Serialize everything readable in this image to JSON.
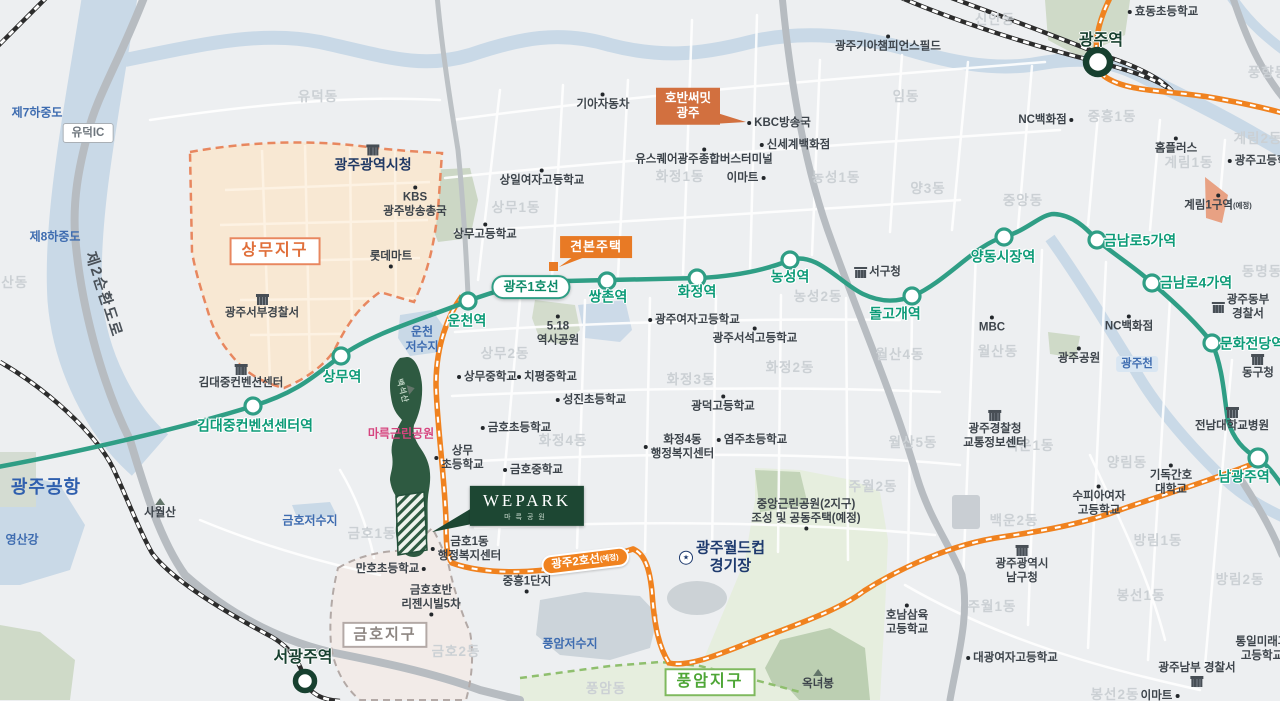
{
  "map": {
    "subway_line1_label": "광주1호선",
    "subway_line2_label": "광주2호선",
    "subway_line2_suffix": "(예정)",
    "colors": {
      "background": "#edeff1",
      "water": "#c9d9e7",
      "line1": "#2f9e85",
      "line2": "#f0821f",
      "park_dark": "#2e5a41",
      "sangmu_fill": "#f8e8d3",
      "sangmu_border": "#e8875f",
      "geumho_fill": "#f2ebe8",
      "pungam_fill": "#e6eede",
      "wepark_box": "#1d4733",
      "callout_orange": "#d2703f",
      "station_text": "#0d9b78",
      "rail_dark": "#17402f"
    },
    "labels": [
      {
        "t": "유덕동",
        "x": 318,
        "y": 97,
        "c": "dong"
      },
      {
        "t": "우산동",
        "x": 8,
        "y": 283,
        "c": "dong"
      },
      {
        "t": "신안동",
        "x": 995,
        "y": 20,
        "c": "dong"
      },
      {
        "t": "임동",
        "x": 906,
        "y": 97,
        "c": "dong"
      },
      {
        "t": "중흥1동",
        "x": 1112,
        "y": 117,
        "c": "dong"
      },
      {
        "t": "풍향동",
        "x": 1268,
        "y": 73,
        "c": "dong"
      },
      {
        "t": "계림2동",
        "x": 1258,
        "y": 139,
        "c": "dong"
      },
      {
        "t": "계림1동",
        "x": 1189,
        "y": 163,
        "c": "dong"
      },
      {
        "t": "양3동",
        "x": 928,
        "y": 189,
        "c": "dong"
      },
      {
        "t": "중앙동",
        "x": 1023,
        "y": 201,
        "c": "dong"
      },
      {
        "t": "동명동",
        "x": 1262,
        "y": 272,
        "c": "dong"
      },
      {
        "t": "상무1동",
        "x": 516,
        "y": 208,
        "c": "dong"
      },
      {
        "t": "화정1동",
        "x": 680,
        "y": 177,
        "c": "dong"
      },
      {
        "t": "농성1동",
        "x": 836,
        "y": 178,
        "c": "dong"
      },
      {
        "t": "상무2동",
        "x": 505,
        "y": 354,
        "c": "dong"
      },
      {
        "t": "농성2동",
        "x": 818,
        "y": 297,
        "c": "dong"
      },
      {
        "t": "화정2동",
        "x": 790,
        "y": 368,
        "c": "dong"
      },
      {
        "t": "화정3동",
        "x": 691,
        "y": 380,
        "c": "dong"
      },
      {
        "t": "화정4동",
        "x": 563,
        "y": 441,
        "c": "dong"
      },
      {
        "t": "월산4동",
        "x": 900,
        "y": 355,
        "c": "dong"
      },
      {
        "t": "월산동",
        "x": 998,
        "y": 352,
        "c": "dong"
      },
      {
        "t": "월산5동",
        "x": 913,
        "y": 443,
        "c": "dong"
      },
      {
        "t": "백운1동",
        "x": 1030,
        "y": 446,
        "c": "dong"
      },
      {
        "t": "백운2동",
        "x": 1014,
        "y": 521,
        "c": "dong"
      },
      {
        "t": "양림동",
        "x": 1127,
        "y": 463,
        "c": "dong"
      },
      {
        "t": "주월2동",
        "x": 873,
        "y": 487,
        "c": "dong"
      },
      {
        "t": "주월1동",
        "x": 992,
        "y": 607,
        "c": "dong"
      },
      {
        "t": "방림1동",
        "x": 1158,
        "y": 541,
        "c": "dong"
      },
      {
        "t": "방림2동",
        "x": 1240,
        "y": 580,
        "c": "dong"
      },
      {
        "t": "봉선1동",
        "x": 1141,
        "y": 596,
        "c": "dong"
      },
      {
        "t": "봉선2동",
        "x": 1115,
        "y": 695,
        "c": "dong"
      },
      {
        "t": "금호1동",
        "x": 372,
        "y": 534,
        "c": "dong"
      },
      {
        "t": "금호2동",
        "x": 456,
        "y": 652,
        "c": "dong"
      },
      {
        "t": "풍암동",
        "x": 606,
        "y": 689,
        "c": "dong"
      },
      {
        "t": "제7하중도",
        "x": 37,
        "y": 113,
        "c": "water"
      },
      {
        "t": "제8하중도",
        "x": 55,
        "y": 237,
        "c": "water"
      },
      {
        "t": "영산강",
        "x": 22,
        "y": 540,
        "c": "water"
      },
      {
        "t": "광주공항",
        "x": 46,
        "y": 488,
        "c": "water-big"
      },
      {
        "t": "운천\n저수지",
        "x": 422,
        "y": 339,
        "c": "water"
      },
      {
        "t": "금호저수지",
        "x": 310,
        "y": 521,
        "c": "water"
      },
      {
        "t": "풍암저수지",
        "x": 570,
        "y": 644,
        "c": "water"
      },
      {
        "t": "광주천",
        "x": 1137,
        "y": 364,
        "c": "wtag"
      },
      {
        "t": "운천역",
        "x": 467,
        "y": 321,
        "c": "st"
      },
      {
        "t": "상무역",
        "x": 342,
        "y": 377,
        "c": "st"
      },
      {
        "t": "김대중컨벤션센터역",
        "x": 255,
        "y": 426,
        "c": "st"
      },
      {
        "t": "쌍촌역",
        "x": 608,
        "y": 297,
        "c": "st"
      },
      {
        "t": "화정역",
        "x": 697,
        "y": 292,
        "c": "st"
      },
      {
        "t": "농성역",
        "x": 790,
        "y": 277,
        "c": "st"
      },
      {
        "t": "돌고개역",
        "x": 895,
        "y": 314,
        "c": "st"
      },
      {
        "t": "양동시장역",
        "x": 1003,
        "y": 257,
        "c": "st"
      },
      {
        "t": "금남로5가역",
        "x": 1140,
        "y": 241,
        "c": "st"
      },
      {
        "t": "금남로4가역",
        "x": 1196,
        "y": 283,
        "c": "st"
      },
      {
        "t": "문화전당역",
        "x": 1252,
        "y": 344,
        "c": "st"
      },
      {
        "t": "남광주역",
        "x": 1244,
        "y": 477,
        "c": "st"
      },
      {
        "t": "광주역",
        "x": 1101,
        "y": 41,
        "c": "strail"
      },
      {
        "t": "서광주역",
        "x": 303,
        "y": 658,
        "c": "strail"
      },
      {
        "t": "광주광역시청",
        "x": 373,
        "y": 159,
        "c": "city",
        "i": "b",
        "ip": "t"
      },
      {
        "t": "광주월드컵\n경기장",
        "x": 722,
        "y": 558,
        "c": "stadium",
        "i": "s",
        "ip": "l"
      },
      {
        "t": "마륵근린공원",
        "x": 401,
        "y": 434,
        "c": "pink"
      },
      {
        "t": "백석산",
        "x": 406,
        "y": 390,
        "c": "white-park",
        "r": 75,
        "i": "m",
        "ip": "t"
      },
      {
        "t": "제2순환도로",
        "x": 103,
        "y": 295,
        "c": "ring",
        "r": 72
      },
      {
        "t": "유덕IC",
        "x": 88,
        "y": 133,
        "c": "icbox"
      },
      {
        "t": "KBS\n광주방송총국",
        "x": 415,
        "y": 202,
        "c": "poi",
        "d": "t"
      },
      {
        "t": "롯데마트",
        "x": 391,
        "y": 259,
        "c": "poi",
        "d": "b"
      },
      {
        "t": "광주서부경찰서",
        "x": 262,
        "y": 307,
        "c": "poi",
        "i": "b",
        "ip": "t"
      },
      {
        "t": "김대중컨벤션센터",
        "x": 241,
        "y": 377,
        "c": "poi",
        "i": "b",
        "ip": "t"
      },
      {
        "t": "상일여자고등학교",
        "x": 542,
        "y": 178,
        "c": "poi",
        "d": "t"
      },
      {
        "t": "기아자동차",
        "x": 603,
        "y": 102,
        "c": "poi",
        "d": "t"
      },
      {
        "t": "KBC방송국",
        "x": 779,
        "y": 123,
        "c": "poi",
        "d": "l"
      },
      {
        "t": "유스퀘어광주종합버스터미널",
        "x": 704,
        "y": 157,
        "c": "poi",
        "d": "t"
      },
      {
        "t": "신세계백화점",
        "x": 795,
        "y": 145,
        "c": "poi",
        "d": "l"
      },
      {
        "t": "이마트",
        "x": 746,
        "y": 178,
        "c": "poi",
        "d": "r"
      },
      {
        "t": "상무고등학교",
        "x": 485,
        "y": 232,
        "c": "poi",
        "d": "t"
      },
      {
        "t": "상무중학교",
        "x": 487,
        "y": 377,
        "c": "poi",
        "d": "l"
      },
      {
        "t": "치평중학교",
        "x": 547,
        "y": 377,
        "c": "poi",
        "d": "l"
      },
      {
        "t": "성진초등학교",
        "x": 591,
        "y": 400,
        "c": "poi",
        "d": "l"
      },
      {
        "t": "금호초등학교",
        "x": 516,
        "y": 428,
        "c": "poi",
        "d": "l"
      },
      {
        "t": "광주여자고등학교",
        "x": 694,
        "y": 320,
        "c": "poi",
        "d": "l"
      },
      {
        "t": "광주서석고등학교",
        "x": 755,
        "y": 336,
        "c": "poi",
        "d": "t"
      },
      {
        "t": "광덕고등학교",
        "x": 723,
        "y": 404,
        "c": "poi",
        "d": "t"
      },
      {
        "t": "5.18\n역사공원",
        "x": 558,
        "y": 331,
        "c": "poi",
        "d": "t"
      },
      {
        "t": "화정4동\n행정복지센터",
        "x": 679,
        "y": 447,
        "c": "poi",
        "d": "l"
      },
      {
        "t": "염주초등학교",
        "x": 752,
        "y": 440,
        "c": "poi",
        "d": "l"
      },
      {
        "t": "금호중학교",
        "x": 533,
        "y": 470,
        "c": "poi",
        "d": "l"
      },
      {
        "t": "상무\n초등학교",
        "x": 459,
        "y": 458,
        "c": "poi",
        "d": "l"
      },
      {
        "t": "만호초등학교",
        "x": 391,
        "y": 569,
        "c": "poi",
        "d": "r"
      },
      {
        "t": "금호호반\n리젠시빌5차",
        "x": 431,
        "y": 600,
        "c": "poi",
        "d": "b"
      },
      {
        "t": "금호1동\n행정복지센터",
        "x": 466,
        "y": 549,
        "c": "poi",
        "d": "l"
      },
      {
        "t": "중흥1단지",
        "x": 527,
        "y": 584,
        "c": "poi",
        "d": "b"
      },
      {
        "t": "사월산",
        "x": 160,
        "y": 509,
        "c": "poi",
        "i": "m",
        "ip": "t"
      },
      {
        "t": "효동초등학교",
        "x": 1163,
        "y": 12,
        "c": "poi",
        "d": "l"
      },
      {
        "t": "광주기아챔피언스필드",
        "x": 888,
        "y": 44,
        "c": "poi",
        "d": "t"
      },
      {
        "t": "NC백화점",
        "x": 1046,
        "y": 120,
        "c": "poi",
        "d": "r"
      },
      {
        "t": "홈플러스",
        "x": 1176,
        "y": 146,
        "c": "poi",
        "d": "t"
      },
      {
        "t": "광주고등학교",
        "x": 1263,
        "y": 161,
        "c": "poi",
        "d": "l"
      },
      {
        "t": "계림1구역",
        "s": "(예정)",
        "x": 1218,
        "y": 203,
        "c": "poi",
        "d": "t"
      },
      {
        "t": "서구청",
        "x": 878,
        "y": 272,
        "c": "poi",
        "i": "b",
        "ip": "l"
      },
      {
        "t": "MBC",
        "x": 992,
        "y": 325,
        "c": "poi",
        "d": "t"
      },
      {
        "t": "광주공원",
        "x": 1079,
        "y": 356,
        "c": "poi",
        "d": "t"
      },
      {
        "t": "NC백화점",
        "x": 1129,
        "y": 324,
        "c": "poi",
        "d": "t"
      },
      {
        "t": "광주동부\n경찰서",
        "x": 1241,
        "y": 307,
        "c": "poi",
        "i": "b",
        "ip": "l"
      },
      {
        "t": "동구청",
        "x": 1258,
        "y": 367,
        "c": "poi",
        "i": "b",
        "ip": "t"
      },
      {
        "t": "전남대학교병원",
        "x": 1232,
        "y": 420,
        "c": "poi",
        "i": "b",
        "ip": "t"
      },
      {
        "t": "기독간호\n대학교",
        "x": 1171,
        "y": 480,
        "c": "poi",
        "d": "t"
      },
      {
        "t": "수피아여자\n고등학교",
        "x": 1099,
        "y": 501,
        "c": "poi",
        "d": "t"
      },
      {
        "t": "광주경찰청\n교통정보센터",
        "x": 995,
        "y": 430,
        "c": "poi",
        "i": "b",
        "ip": "t"
      },
      {
        "t": "광주광역시\n남구청",
        "x": 1022,
        "y": 565,
        "c": "poi",
        "i": "b",
        "ip": "t"
      },
      {
        "t": "호남삼육\n고등학교",
        "x": 907,
        "y": 620,
        "c": "poi",
        "d": "t"
      },
      {
        "t": "대광여자고등학교",
        "x": 1012,
        "y": 658,
        "c": "poi",
        "d": "l"
      },
      {
        "t": "광주남부 경찰서",
        "x": 1197,
        "y": 674,
        "c": "poi",
        "i": "b",
        "ip": "b"
      },
      {
        "t": "이마트",
        "x": 1160,
        "y": 696,
        "c": "poi",
        "d": "r"
      },
      {
        "t": "통일미래과\n고등학교",
        "x": 1262,
        "y": 649,
        "c": "poi"
      },
      {
        "t": "옥녀봉",
        "x": 818,
        "y": 680,
        "c": "poi",
        "i": "m",
        "ip": "t"
      },
      {
        "t": "중앙근린공원(2지구)\n조성 및 공동주택(예정)",
        "x": 806,
        "y": 514,
        "c": "poi",
        "d": "b"
      },
      {
        "t": "상무지구",
        "x": 275,
        "y": 251,
        "c": "d-orange"
      },
      {
        "t": "금호지구",
        "x": 385,
        "y": 635,
        "c": "d-gray"
      },
      {
        "t": "풍암지구",
        "x": 710,
        "y": 682,
        "c": "d-green"
      },
      {
        "t": "광주1호선",
        "x": 531,
        "y": 287,
        "c": "pill1"
      },
      {
        "t": "광주2호선",
        "s": "(예정)",
        "x": 585,
        "y": 561,
        "c": "pill2",
        "r": -7
      },
      {
        "t": "호반써밋\n광주",
        "x": 688,
        "y": 106,
        "c": "co-hoban"
      },
      {
        "t": "견본주택",
        "x": 596,
        "y": 247,
        "c": "co-model"
      },
      {
        "t": "WEPARK\n마륵공원",
        "x": 527,
        "y": 506,
        "c": "wepark"
      }
    ]
  }
}
